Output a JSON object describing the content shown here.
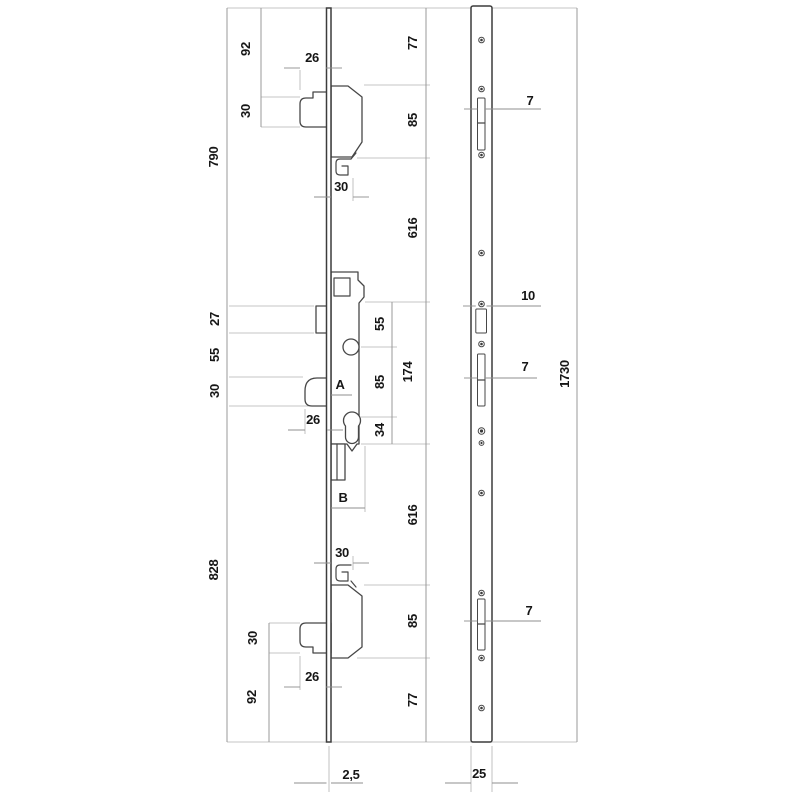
{
  "meta": {
    "description": "Technical line drawing of a multipoint door lock: left view shows the lock faceplate with top/bottom hook-bolt cases, centre gearbox with follower and euro-cylinder holes, latch and deadbolt; right view shows the full-length strike/keep plate with screw holes and keeper slots. Chained dimensions in millimetres.",
    "units": "mm"
  },
  "colors": {
    "background": "#ffffff",
    "part_line": "#474747",
    "dimension_line": "#8f8f8f",
    "extension_line": "#b3b3b3",
    "text": "#161616"
  },
  "lock_view": {
    "parts": [
      "faceplate",
      "top-hook-bolt",
      "top-hook-case",
      "top-hook-detail",
      "deadbolt",
      "latch-bolt",
      "gearbox",
      "follower-hole",
      "euro-cylinder-hole",
      "rod-bracket",
      "bottom-hook-detail",
      "bottom-hook-case",
      "bottom-hook-bolt"
    ],
    "faceplate_thickness": "2,5"
  },
  "strike_view": {
    "parts": [
      "strike-plate",
      "keeper-slots",
      "screw-holes"
    ],
    "plate_width": "25",
    "plate_length": "1730",
    "slot_widths": [
      "7",
      "10",
      "7",
      "7"
    ]
  },
  "labels": {
    "d790": "790",
    "d92_top": "92",
    "d30_top_left": "30",
    "d26_top": "26",
    "d77_top": "77",
    "d85_top": "85",
    "d30_top_h": "30",
    "d616_top": "616",
    "d27": "27",
    "d55_left": "55",
    "d30_left": "30",
    "d55_in": "55",
    "d85_in": "85",
    "d174": "174",
    "dA": "A",
    "d26_mid": "26",
    "d34": "34",
    "dB": "B",
    "d616_bot": "616",
    "d828": "828",
    "d30_bot_h": "30",
    "d85_bot": "85",
    "d30_bot_left": "30",
    "d92_bot": "92",
    "d26_bot": "26",
    "d77_bot": "77",
    "d2_5": "2,5",
    "d25": "25",
    "d7_top": "7",
    "d10": "10",
    "d7_mid": "7",
    "d7_bot": "7",
    "d1730": "1730"
  }
}
